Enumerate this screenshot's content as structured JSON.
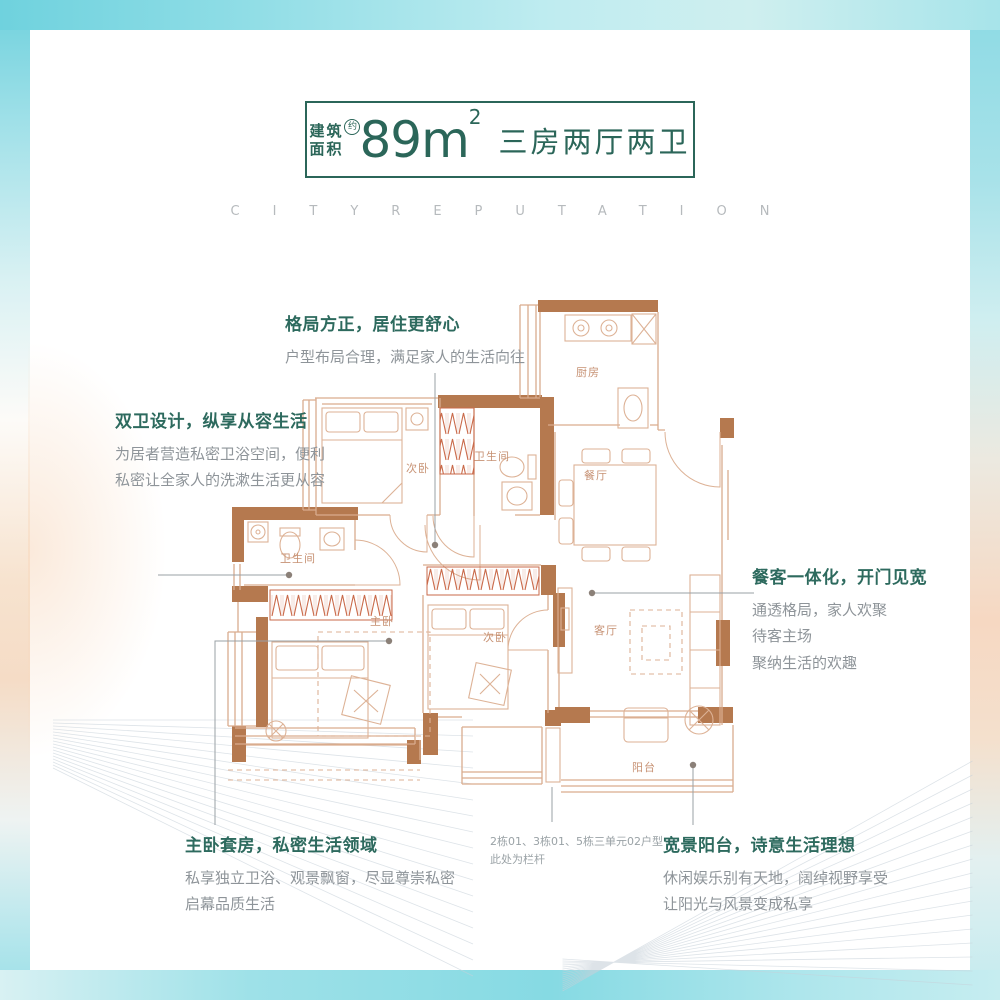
{
  "header": {
    "area_label_top": "建筑",
    "area_label_bottom": "面积",
    "approx": "约",
    "area_value": "89m",
    "area_exponent": "2",
    "layout_type": "三房两厅两卫"
  },
  "watermark": "CITYREPUTATION",
  "floorplan": {
    "rooms": [
      {
        "id": "kitchen",
        "label": "厨房"
      },
      {
        "id": "bedroom-2",
        "label": "次卧"
      },
      {
        "id": "bathroom-1",
        "label": "卫生间"
      },
      {
        "id": "dining",
        "label": "餐厅"
      },
      {
        "id": "bathroom-2",
        "label": "卫生间"
      },
      {
        "id": "master-bedroom",
        "label": "主卧"
      },
      {
        "id": "bedroom-3",
        "label": "次卧"
      },
      {
        "id": "living",
        "label": "客厅"
      },
      {
        "id": "balcony",
        "label": "阳台"
      }
    ],
    "note_line1": "2栋01、3栋01、5栋三单元02户型",
    "note_line2": "此处为栏杆"
  },
  "annotations": [
    {
      "title": "格局方正，居住更舒心",
      "lines": [
        "户型布局合理，满足家人的生活向往"
      ]
    },
    {
      "title": "双卫设计，纵享从容生活",
      "lines": [
        "为居者营造私密卫浴空间，便利",
        "私密让全家人的洗漱生活更从容"
      ]
    },
    {
      "title": "餐客一体化，开门见宽",
      "lines": [
        "通透格局，家人欢聚",
        "待客主场",
        "聚纳生活的欢趣"
      ]
    },
    {
      "title": "主卧套房，私密生活领域",
      "lines": [
        "私享独立卫浴、观景飘窗，尽显尊崇私密",
        "启幕品质生活"
      ]
    },
    {
      "title": "宽景阳台，诗意生活理想",
      "lines": [
        "休闲娱乐别有天地，阔绰视野享受",
        "让阳光与风景变成私享"
      ]
    }
  ],
  "colors": {
    "accent_green": "#2b6659",
    "wall_brown": "#b5794f",
    "plan_line": "#d9ac8e",
    "wardrobe_red": "#c96a4a",
    "frame_cyan": "#7dd6e1",
    "frame_peach": "#f6d8c2"
  }
}
